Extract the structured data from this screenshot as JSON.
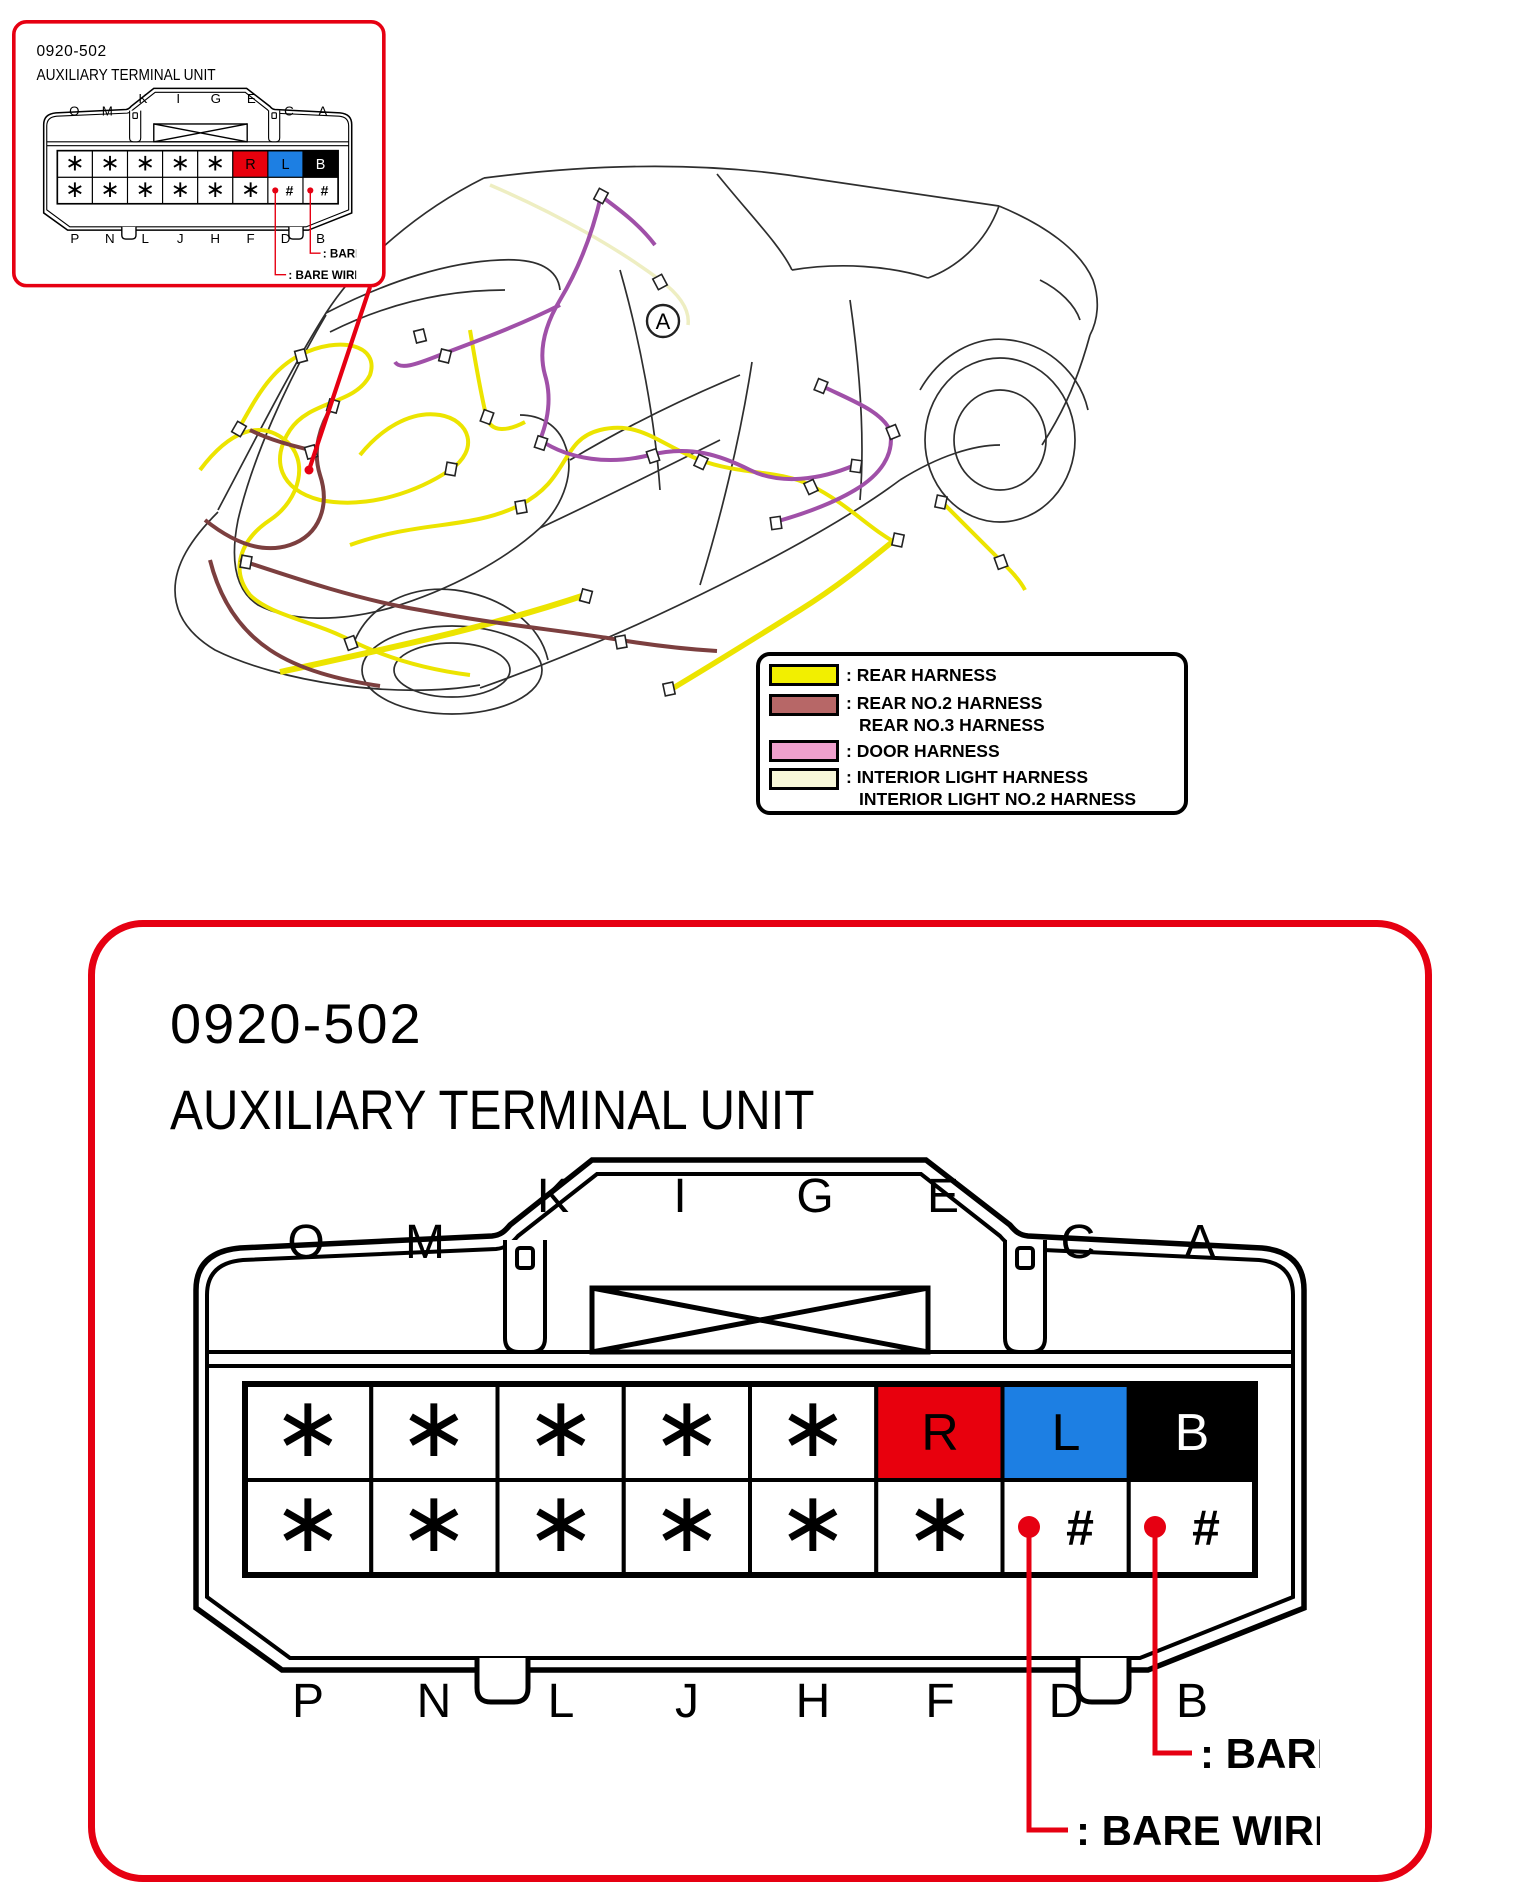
{
  "page": {
    "background": "#ffffff"
  },
  "unit": {
    "code": "0920-502",
    "name": "AUXILIARY TERMINAL UNIT",
    "top_pin_labels": [
      "O",
      "M",
      "K",
      "I",
      "G",
      "E",
      "C",
      "A"
    ],
    "bottom_pin_labels": [
      "P",
      "N",
      "L",
      "J",
      "H",
      "F",
      "D",
      "B"
    ],
    "top_row_cells": [
      "∗",
      "∗",
      "∗",
      "∗",
      "∗",
      "R",
      "L",
      "B"
    ],
    "bottom_row_cells": [
      "∗",
      "∗",
      "∗",
      "∗",
      "∗",
      "∗",
      "#",
      "#"
    ],
    "bare_wire_note_1": ": BARE WIRE",
    "bare_wire_note_2": ": BARE WIRE",
    "colors": {
      "accent": "#e60012",
      "r_cell": "#e8000d",
      "l_cell": "#1d7fe3",
      "b_cell": "#000000",
      "r_text": "#000000",
      "l_text": "#000000",
      "b_text": "#ffffff",
      "bare_dot": "#e60012"
    }
  },
  "car": {
    "callout_label": "A",
    "harness_colors": {
      "rear": "#ece400",
      "rear_no2": "#7c3f3f",
      "door": "#a050a8",
      "interior_light": "#eeeec2"
    }
  },
  "legend": {
    "items": [
      {
        "color": "#f2ef00",
        "lines": [
          ": REAR HARNESS",
          ""
        ]
      },
      {
        "color": "#b76767",
        "lines": [
          ": REAR NO.2 HARNESS",
          "REAR NO.3 HARNESS"
        ]
      },
      {
        "color": "#efa0cd",
        "lines": [
          ": DOOR HARNESS",
          ""
        ]
      },
      {
        "color": "#f8f8d8",
        "lines": [
          ": INTERIOR LIGHT HARNESS",
          "INTERIOR LIGHT NO.2 HARNESS"
        ]
      }
    ]
  }
}
